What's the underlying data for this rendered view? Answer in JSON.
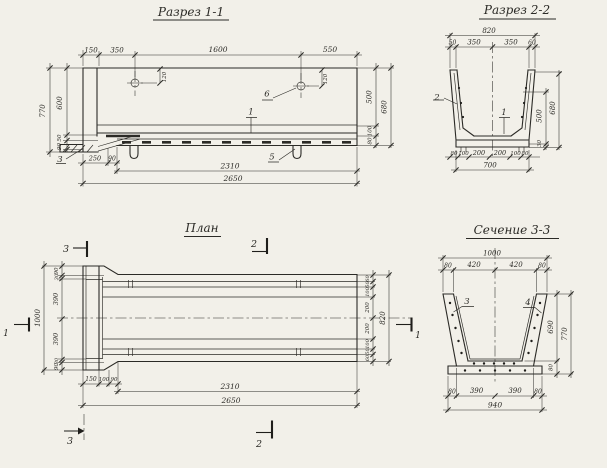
{
  "colors": {
    "paper": "#f2f0e9",
    "ink": "#2b2a26"
  },
  "section11": {
    "title": "Разрез 1-1",
    "dims": {
      "top": [
        "150",
        "350",
        "1600",
        "550"
      ],
      "hole_offsets": [
        "120",
        "120"
      ],
      "left": {
        "outer": "770",
        "inner": "600",
        "small_top": "50",
        "small_bottom": "90"
      },
      "right": {
        "inner": "500",
        "outer": "680",
        "small_top": "100",
        "small_bottom": "80"
      },
      "bottom": {
        "d250": "250",
        "d90": "90",
        "d2310": "2310",
        "d2650": "2650"
      }
    },
    "part_labels": {
      "p1": "1",
      "p3": "3",
      "p5": "5",
      "p6": "6"
    }
  },
  "section22": {
    "title": "Разрез 2-2",
    "dims": {
      "overall_top": "820",
      "top_row": [
        "50",
        "350",
        "350",
        "60"
      ],
      "right": {
        "inner": "500",
        "outer": "680",
        "small": "30"
      },
      "bottom_row": [
        "80",
        "100",
        "200",
        "200",
        "100",
        "80"
      ],
      "overall_bottom": "700"
    },
    "part_labels": {
      "p1": "1",
      "p2": "2"
    }
  },
  "plan": {
    "title": "План",
    "dims": {
      "left_overall": "1000",
      "left_stack": [
        "90",
        "30",
        "390",
        "390",
        "30",
        "90"
      ],
      "right_stack": [
        "60",
        "50",
        "100",
        "200",
        "200",
        "100",
        "50",
        "60"
      ],
      "right_overall": "820",
      "bottom_row": [
        "150",
        "100",
        "90"
      ],
      "bottom_2310": "2310",
      "bottom_2650": "2650"
    },
    "section_markers": {
      "m1_left": "1",
      "m1_right": "1",
      "m2_top": "2",
      "m2_bottom": "2",
      "m3_top": "3",
      "m3_bottom": "3"
    }
  },
  "section33": {
    "title": "Сечение 3-3",
    "dims": {
      "overall_top": "1000",
      "top_row": [
        "80",
        "420",
        "420",
        "80"
      ],
      "right": {
        "inner": "690",
        "outer": "770",
        "small": "80"
      },
      "bottom_row": [
        "80",
        "390",
        "390",
        "80"
      ],
      "overall_bottom": "940"
    },
    "part_labels": {
      "p3": "3",
      "p4": "4"
    }
  }
}
